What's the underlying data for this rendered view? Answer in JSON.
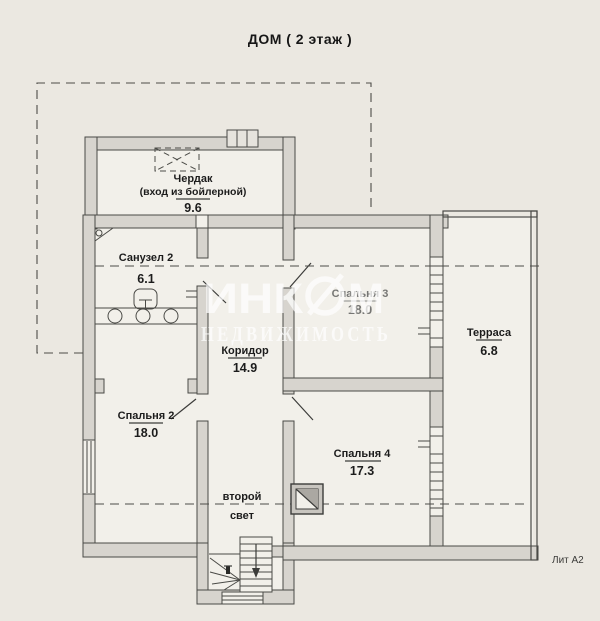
{
  "title": "ДОМ ( 2 этаж )",
  "lit_label": "Лит А2",
  "watermark": {
    "brand_left": "ИНК",
    "brand_right": "М",
    "subtitle": "НЕДВИЖИМОСТЬ"
  },
  "rooms": {
    "attic": {
      "name": "Чердак",
      "note": "(вход из бойлерной)",
      "area": "9.6"
    },
    "bathroom2": {
      "name": "Санузел 2",
      "area": "6.1"
    },
    "bedroom3": {
      "name": "Спальня 3",
      "area": "18.0"
    },
    "corridor": {
      "name": "Коридор",
      "area": "14.9"
    },
    "terrace": {
      "name": "Терраса",
      "area": "6.8"
    },
    "bedroom2": {
      "name": "Спальня 2",
      "area": "18.0"
    },
    "bedroom4": {
      "name": "Спальня 4",
      "area": "17.3"
    },
    "second_light": {
      "word1": "второй",
      "word2": "свет"
    }
  },
  "colors": {
    "paper": "#ebe8e1",
    "room": "#f2f0ea",
    "wall_fill": "#d7d4ce",
    "line": "#4a4a46",
    "text": "#1c1c1c",
    "faded_text": "#767674",
    "watermark": "#ffffff"
  }
}
